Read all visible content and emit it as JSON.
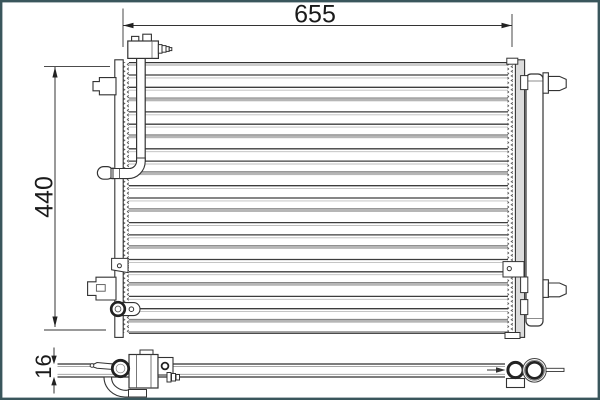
{
  "diagram": {
    "type": "technical-drawing",
    "subject": "condenser",
    "dimension_width_label": "655",
    "dimension_height_label": "440",
    "dimension_depth_label": "16"
  },
  "style": {
    "frame_color": "#3a565c",
    "line_color": "#333333",
    "light_line_color": "#9a9a9a",
    "band_color": "#b6b6b6",
    "plate_fill": "#dcdcdc",
    "background": "#ffffff"
  },
  "core": {
    "tube_rows": 21,
    "first_y": 75,
    "spacing": 12.3,
    "left": 129,
    "right": 508
  }
}
